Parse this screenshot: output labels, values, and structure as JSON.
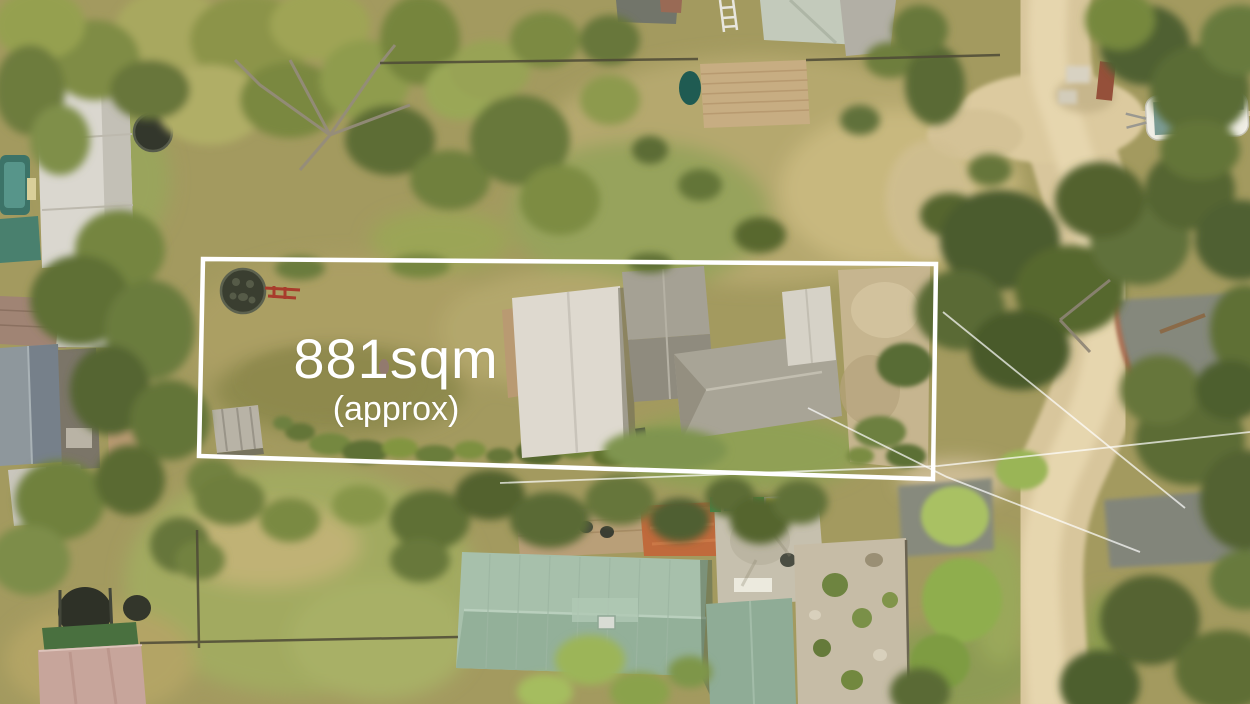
{
  "annotation": {
    "area_label": "881sqm",
    "area_qualifier": "(approx)",
    "text_color": "#ffffff",
    "boundary_color": "#ffffff"
  },
  "palette": {
    "dry_grass": "#a89c60",
    "lawn_green": "#90a055",
    "dirt_road": "#d8c69c",
    "asphalt": "#85887b",
    "tree_dark": "#4c5c2e",
    "green_roof": "#a2bda7",
    "white_roof": "#ded9cf",
    "grey_shingle_roof": "#a5a194",
    "terracotta_patio": "#c06a3c",
    "deck_wood": "#c7ad82",
    "teal_pool": "#3c7368"
  }
}
